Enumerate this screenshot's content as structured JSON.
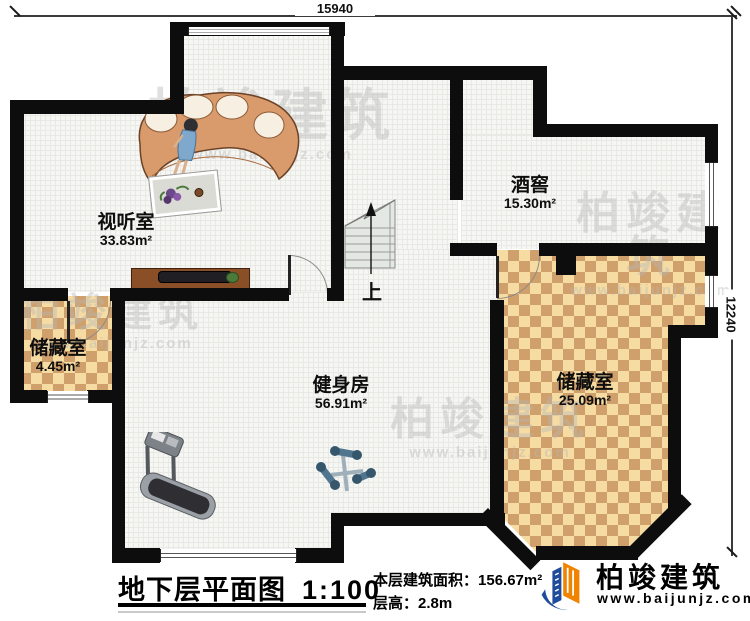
{
  "dimensions": {
    "top": "15940",
    "right": "12240"
  },
  "rooms": [
    {
      "name": "视听室",
      "area": "33.83m²"
    },
    {
      "name": "酒窖",
      "area": "15.30m²"
    },
    {
      "name": "储藏室",
      "area": "4.45m²"
    },
    {
      "name": "健身房",
      "area": "56.91m²"
    },
    {
      "name": "储藏室",
      "area": "25.09m²"
    }
  ],
  "stairs": {
    "label": "上"
  },
  "title_block": {
    "title": "地下层平面图",
    "scale": "1:100",
    "area_label": "本层建筑面积：",
    "area_value": "156.67m²",
    "floor_height_label": "层高：",
    "floor_height_value": "2.8m"
  },
  "brand": {
    "name": "柏竣建筑",
    "url": "www.baijunjz.com"
  },
  "watermark": {
    "name": "柏竣建筑",
    "url": "www.baijunjz.com"
  },
  "colors": {
    "wall": "#0d0d0d",
    "checker_light": "#f6dca3",
    "checker_dark": "#cfa06b",
    "logo_blue": "#1e4b9b",
    "logo_orange": "#f08300"
  }
}
